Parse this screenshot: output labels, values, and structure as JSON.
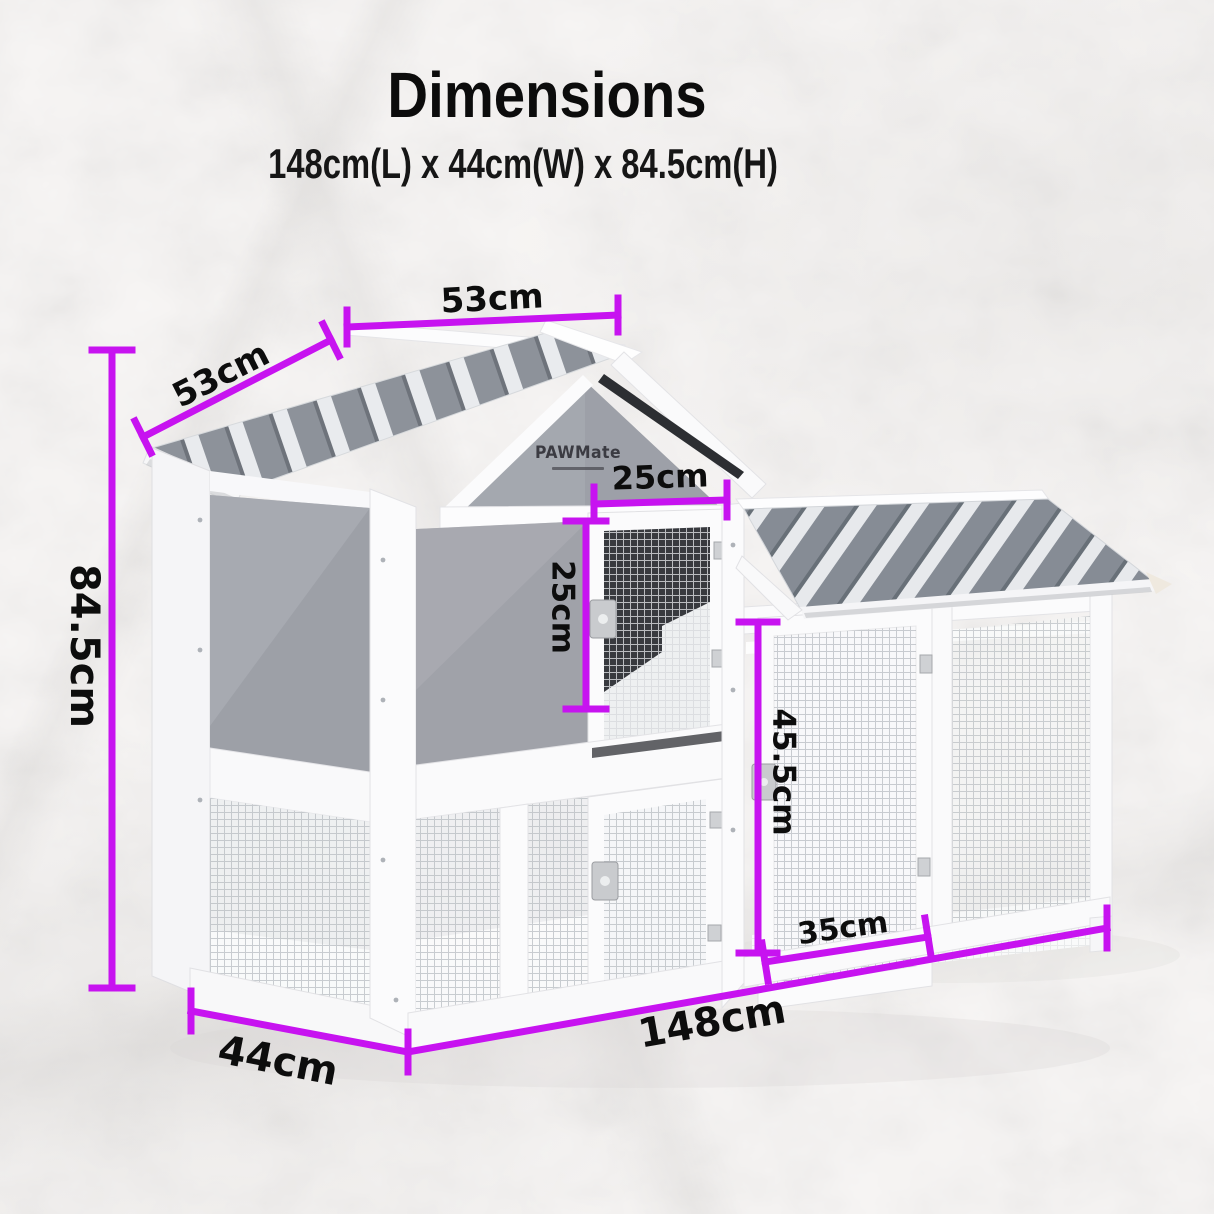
{
  "header": {
    "title": "Dimensions",
    "subtitle": "148cm(L) x 44cm(W) x 84.5cm(H)"
  },
  "brand": {
    "logo": "PAWMate"
  },
  "dimensions": {
    "total_height": "84.5cm",
    "total_length": "148cm",
    "total_width": "44cm",
    "roof_panel_depth": "53cm",
    "roof_panel_width": "53cm",
    "hutch_door_width": "25cm",
    "hutch_door_height": "25cm",
    "run_door_height": "45.5cm",
    "run_door_width": "35cm"
  },
  "colors": {
    "dimension_line": "#C713F0",
    "label_text": "#0D0D0D",
    "roof_grey": "#8D929A",
    "panel_grey": "#9DA0A8"
  }
}
